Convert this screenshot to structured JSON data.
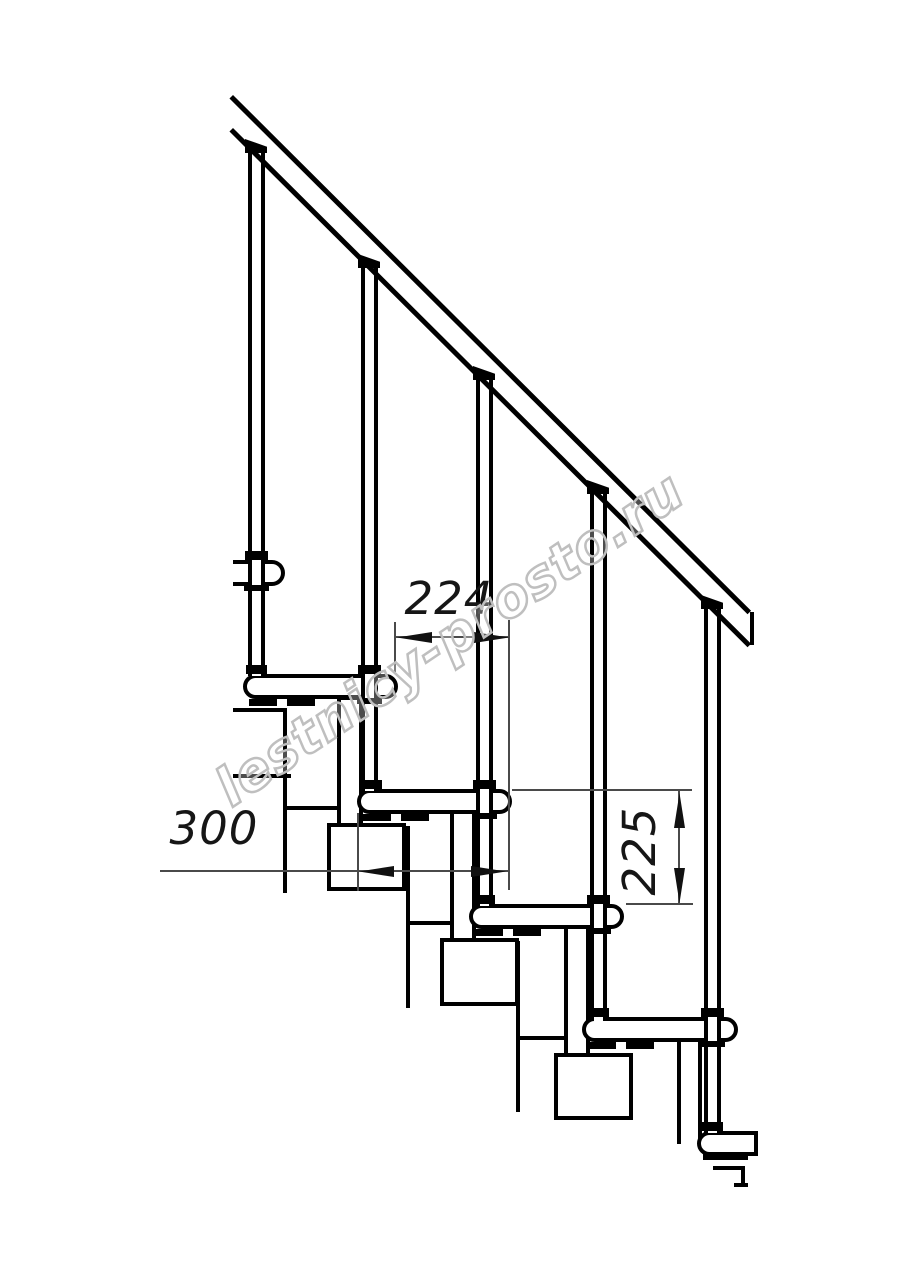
{
  "drawing": {
    "type": "staircase-side-view-technical-drawing",
    "background": "#ffffff",
    "ink_color": "#000000",
    "thin_line_color": "#4a4a4a",
    "treads_visible": 6,
    "balusters_visible": 5,
    "watermark": {
      "text": "lestnicy-prosto.ru",
      "color": "#bfbfbf"
    },
    "dimensions": {
      "d224": {
        "label": "224"
      },
      "d300": {
        "label": "300"
      },
      "d225": {
        "label": "225"
      }
    }
  }
}
